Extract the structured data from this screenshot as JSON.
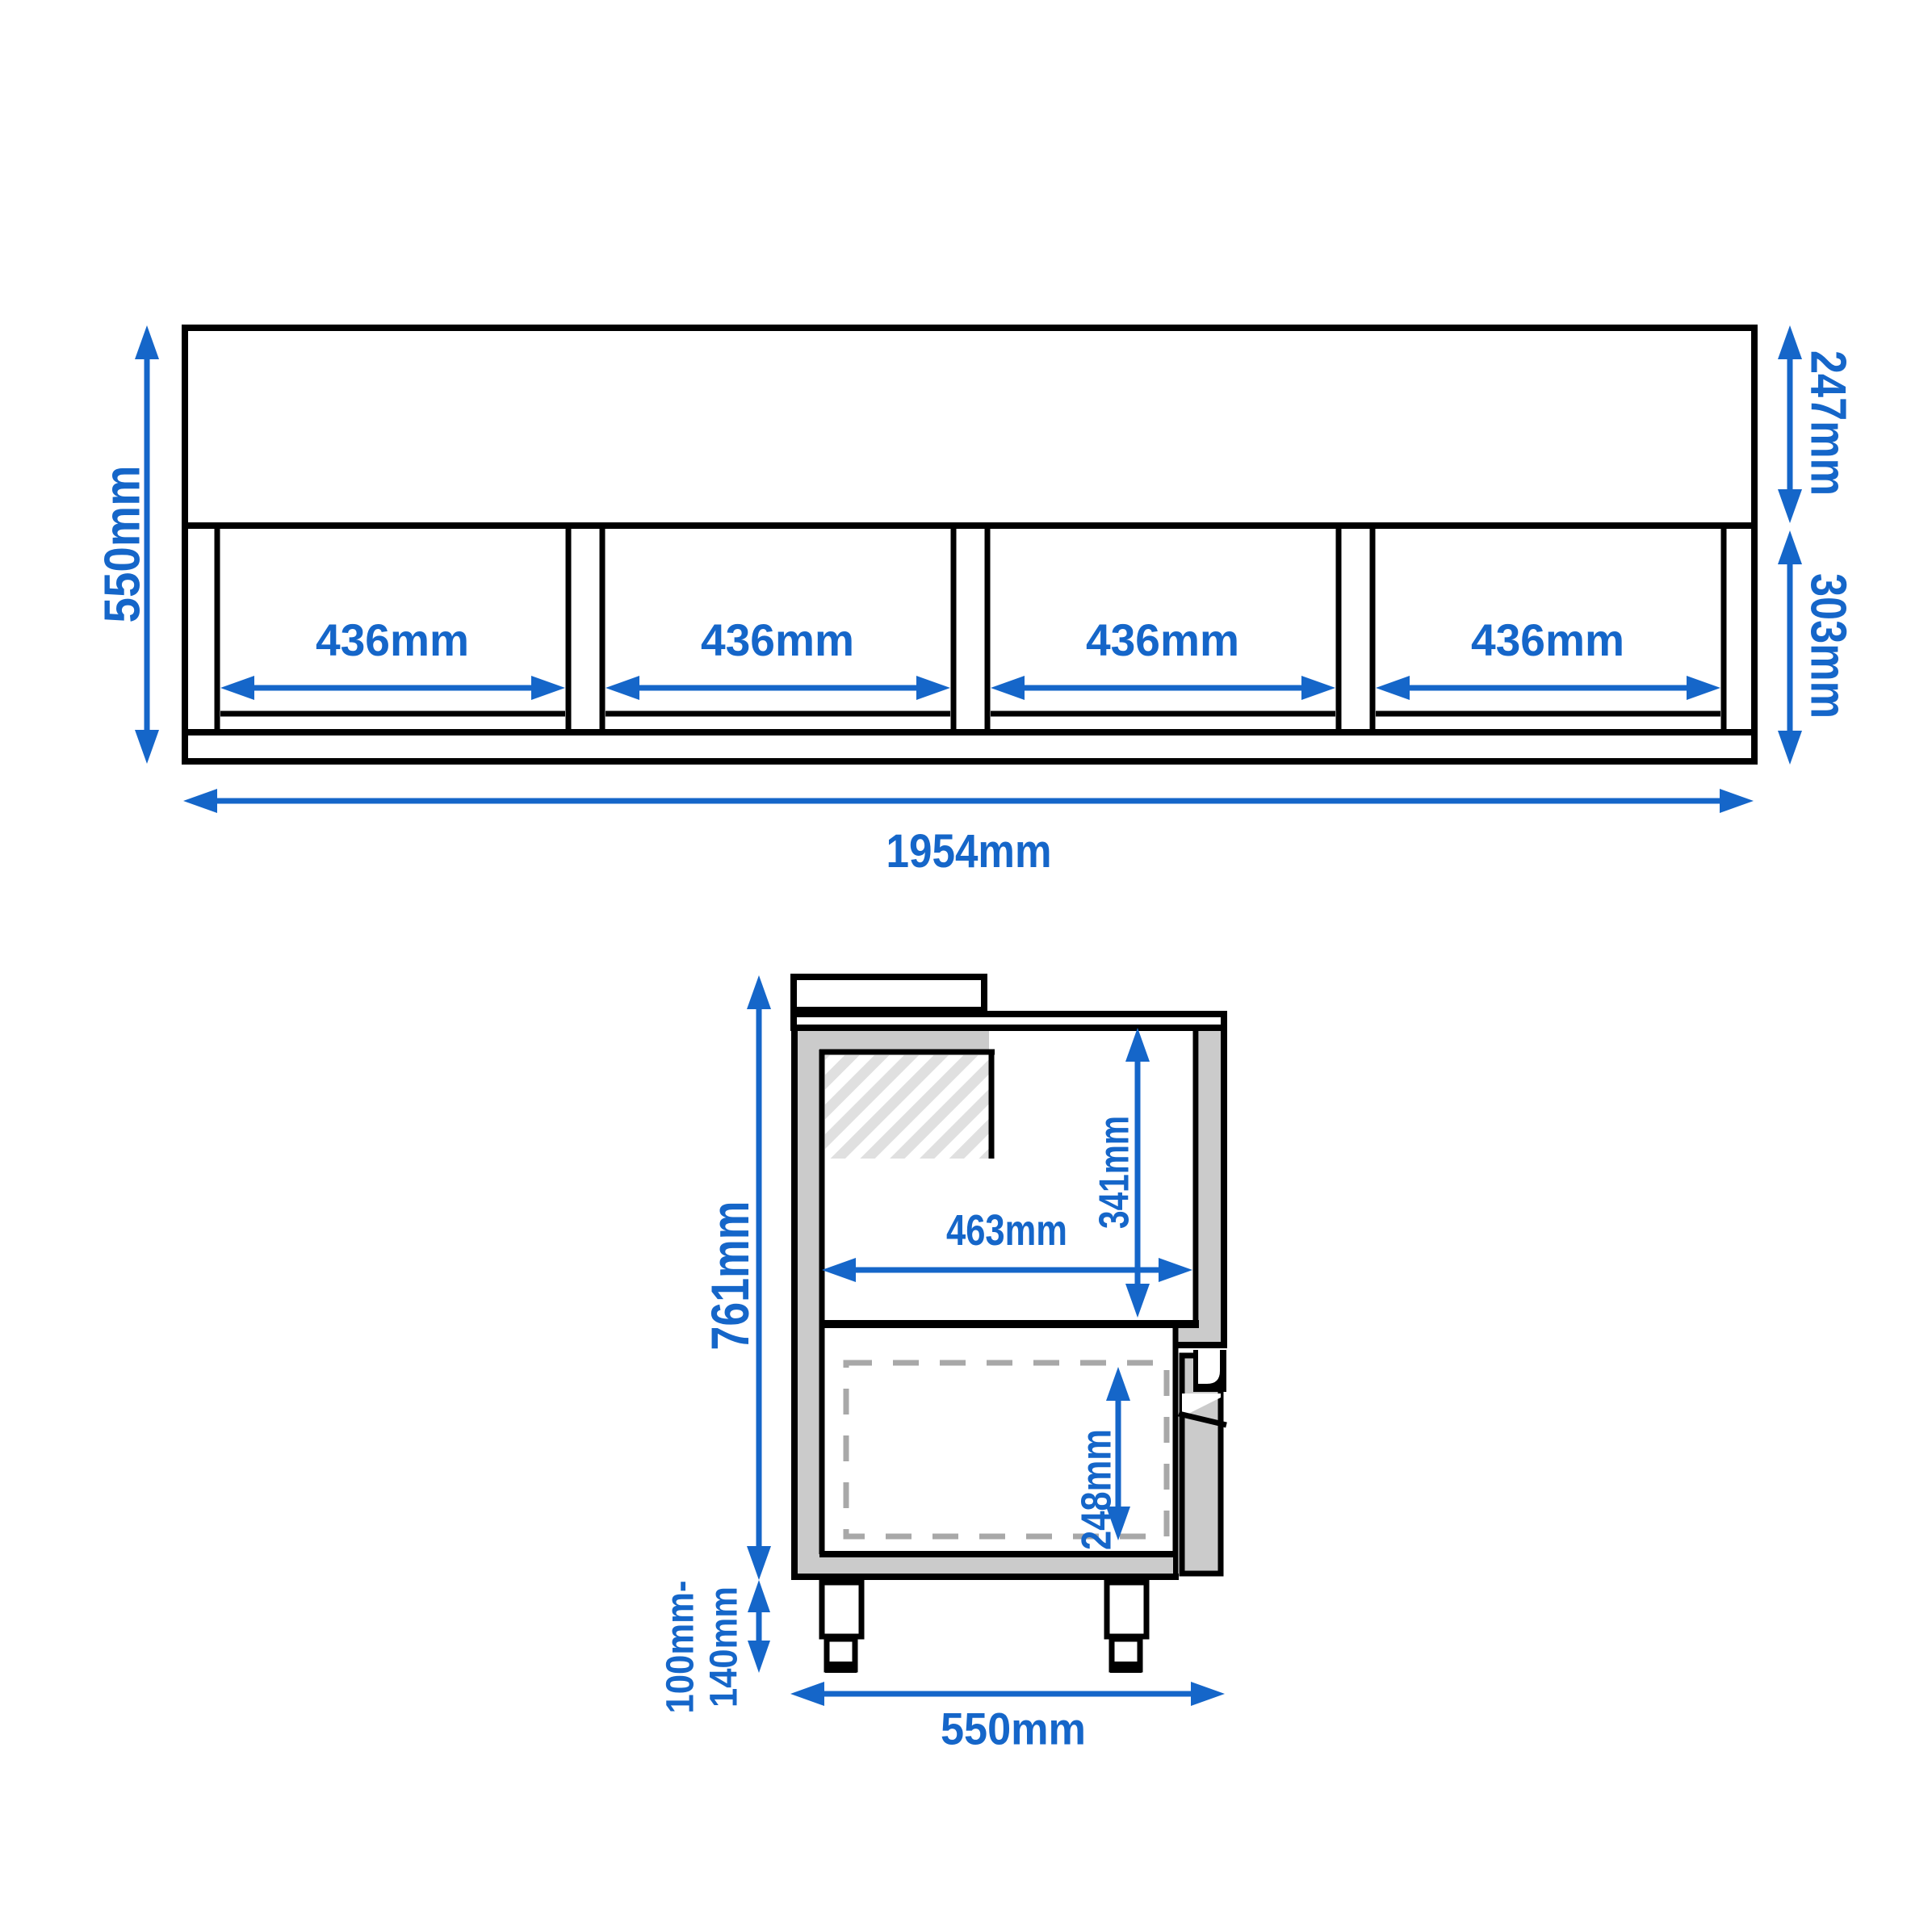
{
  "colors": {
    "dimension_blue": "#1566c9",
    "line_black": "#000000",
    "wall_gray": "#cbcbcb",
    "hatch_gray": "#e0e0e0",
    "dash_gray": "#a8a8a8"
  },
  "front_view": {
    "overall_height": "550mm",
    "upper_section_height": "247mm",
    "lower_section_height": "303mm",
    "overall_width": "1954mm",
    "openings": [
      "436mm",
      "436mm",
      "436mm",
      "436mm"
    ]
  },
  "side_view": {
    "overall_height": "761mm",
    "interior_height": "341mm",
    "interior_width": "463mm",
    "drawer_height": "248mm",
    "leg_height_min": "100mm-",
    "leg_height_max": "140mm",
    "overall_depth": "550mm"
  }
}
